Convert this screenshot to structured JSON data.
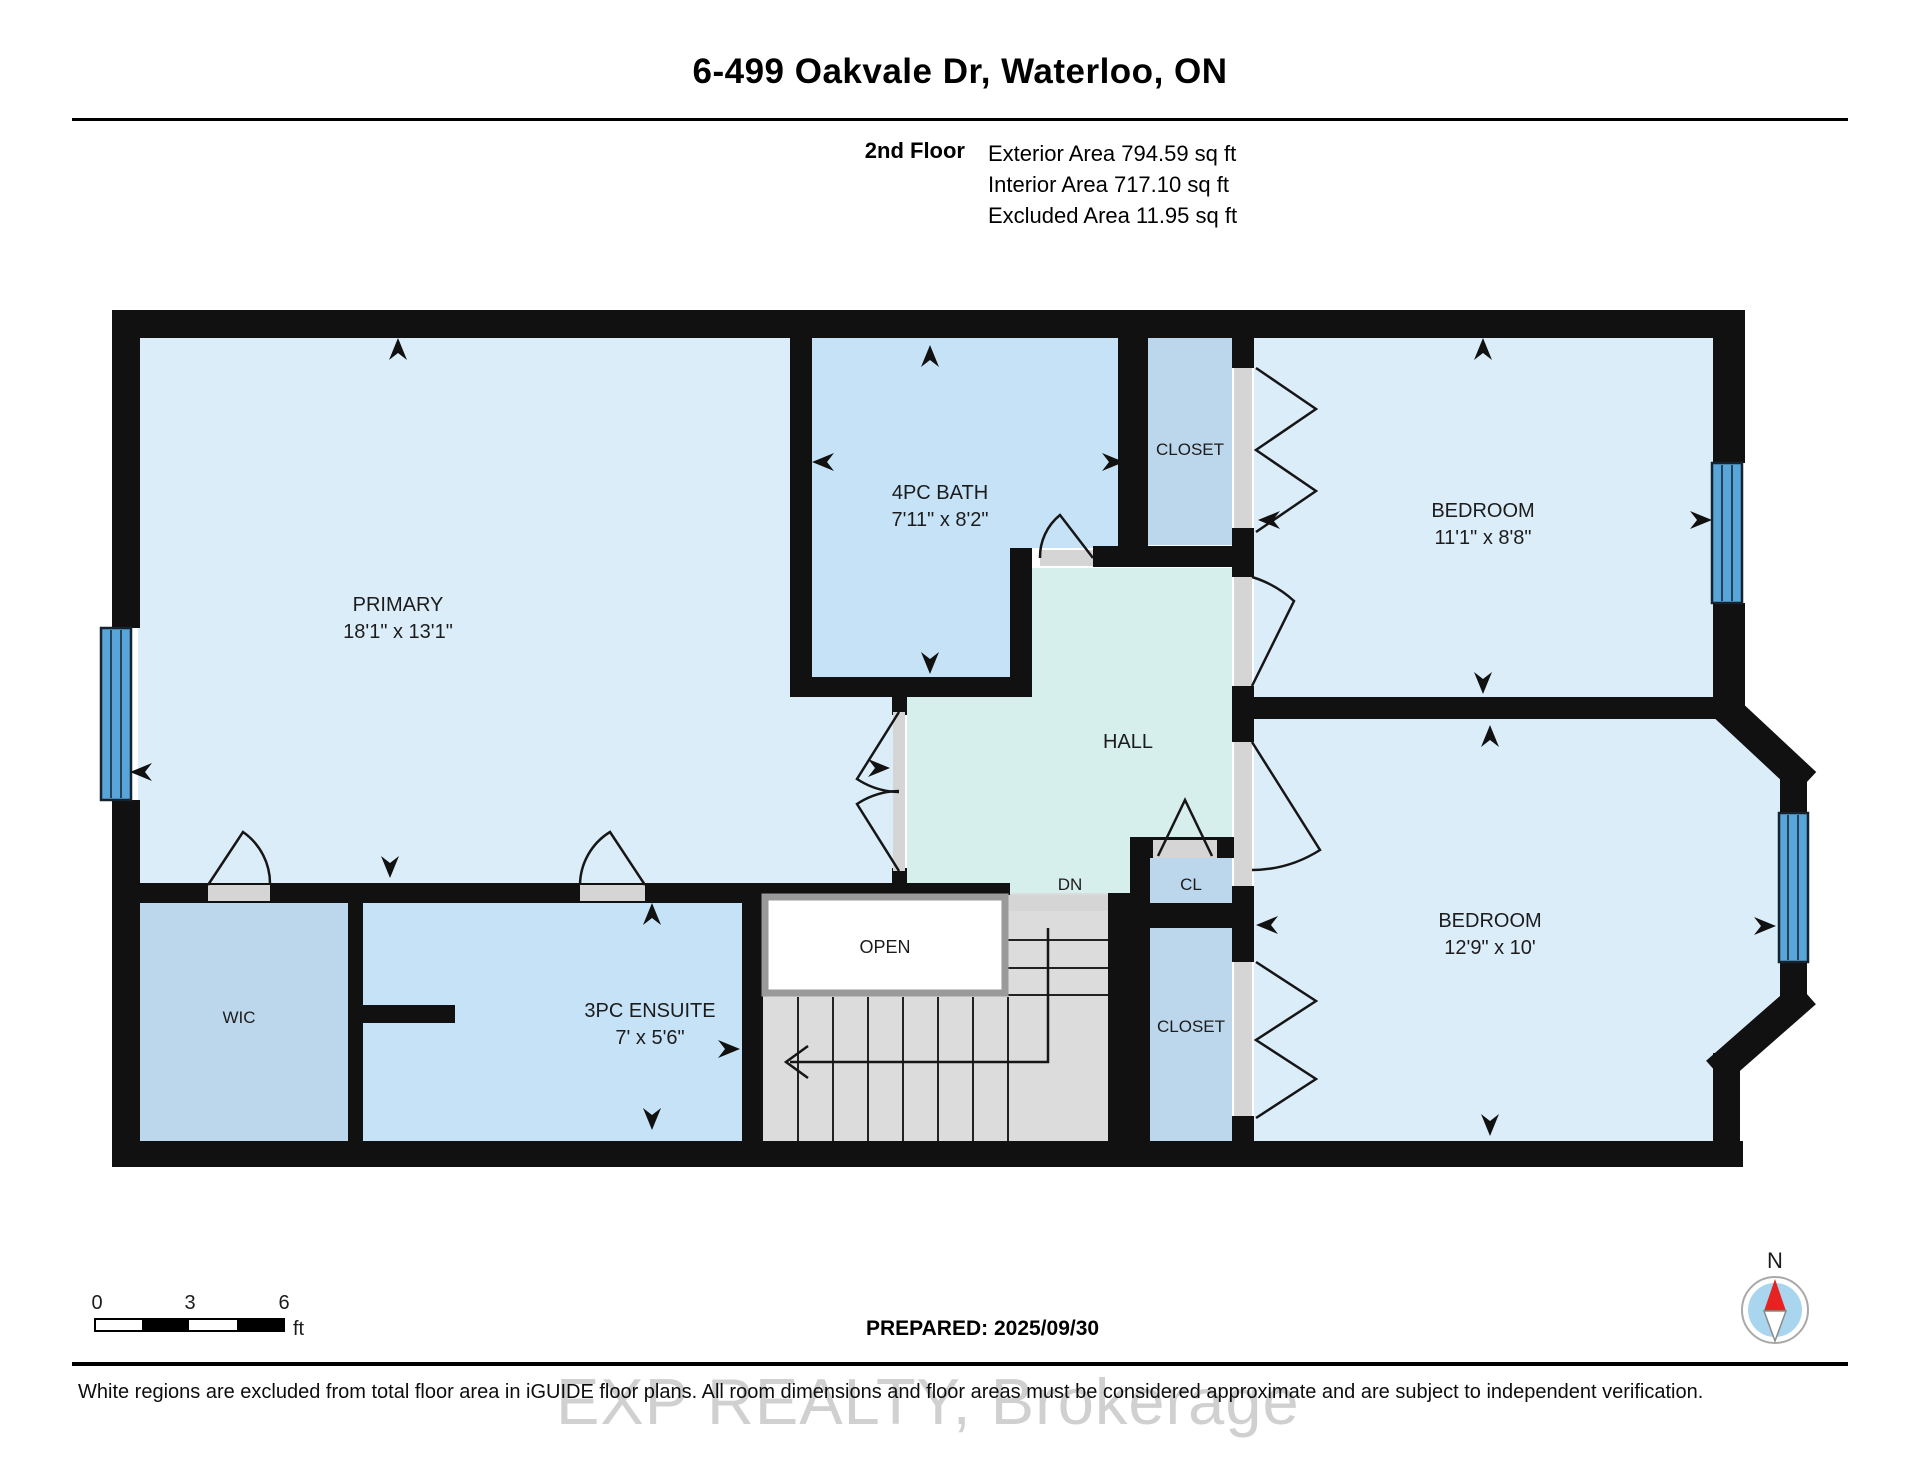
{
  "header": {
    "title": "6-499 Oakvale Dr, Waterloo, ON",
    "floor": "2nd Floor",
    "exterior": "Exterior Area 794.59 sq ft",
    "interior": "Interior Area 717.10 sq ft",
    "excluded": "Excluded Area 11.95 sq ft"
  },
  "rooms": {
    "primary": {
      "name": "PRIMARY",
      "dims": "18'1\" x 13'1\""
    },
    "bath": {
      "name": "4PC BATH",
      "dims": "7'11\" x 8'2\""
    },
    "closet_top": {
      "name": "CLOSET"
    },
    "bedroom1": {
      "name": "BEDROOM",
      "dims": "11'1\" x 8'8\""
    },
    "hall": {
      "name": "HALL"
    },
    "stairs": {
      "dn": "DN",
      "open": "OPEN"
    },
    "cl": {
      "name": "CL"
    },
    "wic": {
      "name": "WIC"
    },
    "ensuite": {
      "name": "3PC ENSUITE",
      "dims": "7' x 5'6\""
    },
    "closet_bottom": {
      "name": "CLOSET"
    },
    "bedroom2": {
      "name": "BEDROOM",
      "dims": "12'9\" x 10'"
    }
  },
  "footer": {
    "scale": {
      "t0": "0",
      "t3": "3",
      "t6": "6",
      "unit": "ft"
    },
    "prepared": "PREPARED: 2025/09/30",
    "compass_n": "N",
    "watermark": "EXP REALTY, Brokerage",
    "disclaimer": "White regions are excluded from total floor area in iGUIDE floor plans. All room dimensions and floor areas must be considered approximate and are subject to independent verification."
  },
  "colors": {
    "wall": "#111111",
    "room_fill": "#dcedfa",
    "wet_fill": "#c6e2f7",
    "closet_fill": "#bcd6ec",
    "hall_fill": "#d7efec",
    "stairs_fill": "#dcdcdc",
    "sill_fill": "#d5d5d5",
    "window_fill": "#57a5d9",
    "compass_red": "#e62320"
  }
}
